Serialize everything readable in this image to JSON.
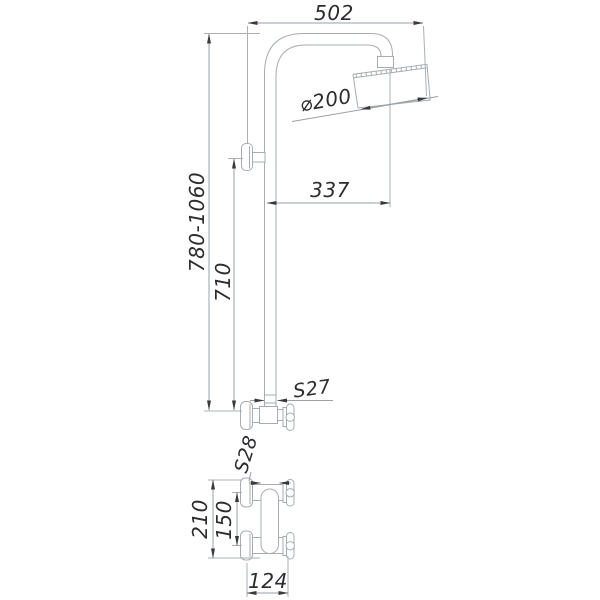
{
  "drawing": {
    "kind": "shower-system-wall-mounted-technical-drawing",
    "labels": {
      "top_width": "502",
      "head_diameter": "⌀200",
      "head_offset": "337",
      "overall_height_range": "780-1060",
      "riser_height": "710",
      "riser_nut_size": "S27",
      "mixer_nut_size": "S28",
      "mixer_overall_height": "210",
      "mixer_centers_distance": "150",
      "mixer_depth": "124"
    }
  }
}
